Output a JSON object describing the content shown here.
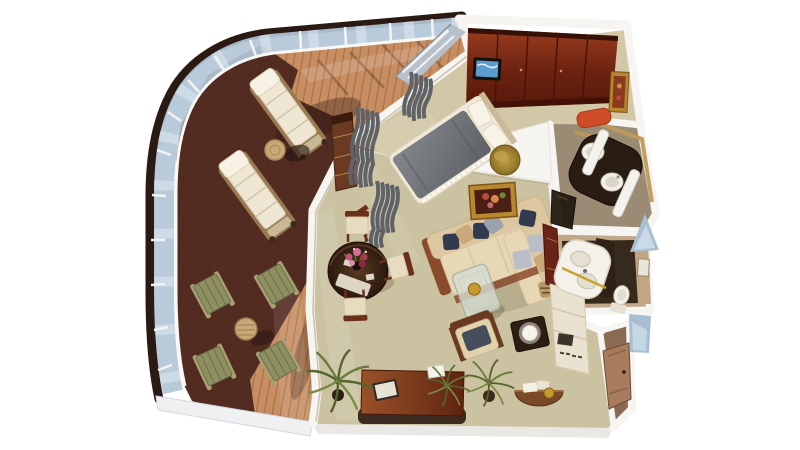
{
  "palette": {
    "background": "#ffffff",
    "hull": "#2b1a13",
    "glass": "#b3c7d7",
    "glass_light": "#dfe9f1",
    "rail_white": "#f8f8f5",
    "deck_light": "#c78e62",
    "deck_shadow": "#49241c",
    "wall": "#f7f5f1",
    "carpet": "#cbc2a1",
    "bedroom_floor": "#d2c7a6",
    "closet_wood": "#7c2a16",
    "tv_screen": "#5b9bd0",
    "curtain": "#5f6368",
    "bed_duvet": "#6d7175",
    "bed_linen": "#f1e9d8",
    "ottoman_gold": "#9c7c2c",
    "sofa_cream": "#dcc7a0",
    "sofa_seat": "#e7d7b4",
    "pillow_navy": "#313a4e",
    "pillow_tan": "#c9a97c",
    "table_wood_dark": "#3a2318",
    "chair_wood": "#6b3018",
    "painting_frame": "#b8872f",
    "stool_orange": "#cf4e28",
    "vanity_dark": "#291c13",
    "porcelain": "#f4f1ea",
    "bath_floor": "#9b8b75",
    "bath2_floor": "#362a1c",
    "gold_trim": "#c8a232",
    "hall_floor": "#8a6a52",
    "door_wood": "#a87b5e",
    "corridor_blue": "#a9bfd1",
    "desk_wood": "#7a3018",
    "cabinet_cream": "#eae2d0",
    "plant_green": "#55652e"
  },
  "scene": {
    "type": "3d-isometric-floorplan",
    "subject": "cruise-ship-suite-with-wraparound-balcony",
    "rooms": [
      {
        "name": "balcony-deck",
        "furniture": [
          "sun-lounger",
          "sun-lounger",
          "wicker-side-table",
          "folding-deck-chair",
          "folding-deck-chair",
          "folding-deck-chair",
          "folding-deck-chair",
          "round-deck-table",
          "glass-railing"
        ]
      },
      {
        "name": "bedroom",
        "furniture": [
          "double-bed",
          "gold-ottoman",
          "wardrobe-closet",
          "wall-tv",
          "curtains",
          "dresser",
          "side-chair",
          "partition-window"
        ]
      },
      {
        "name": "living-dining-room",
        "furniture": [
          "round-dining-table",
          "flower-bouquet",
          "dining-chair",
          "dining-chair",
          "dining-chair",
          "sectional-sofa",
          "throw-pillows",
          "framed-painting",
          "glass-coffee-table",
          "armchair",
          "lamp-side-table",
          "tall-artwork-panel",
          "storage-cabinet",
          "writing-desk",
          "book",
          "potted-palm",
          "potted-palm",
          "potted-palm",
          "half-moon-console"
        ]
      },
      {
        "name": "master-bathroom",
        "furniture": [
          "double-sink-vanity",
          "towel-column",
          "towel-column",
          "bathtub",
          "vanity-stool",
          "framed-picture"
        ]
      },
      {
        "name": "guest-bathroom",
        "furniture": [
          "curved-sink-counter",
          "gold-towel-bar",
          "toilet",
          "framed-mirror"
        ]
      },
      {
        "name": "entry-hall",
        "furniture": [
          "entry-door"
        ]
      }
    ]
  }
}
